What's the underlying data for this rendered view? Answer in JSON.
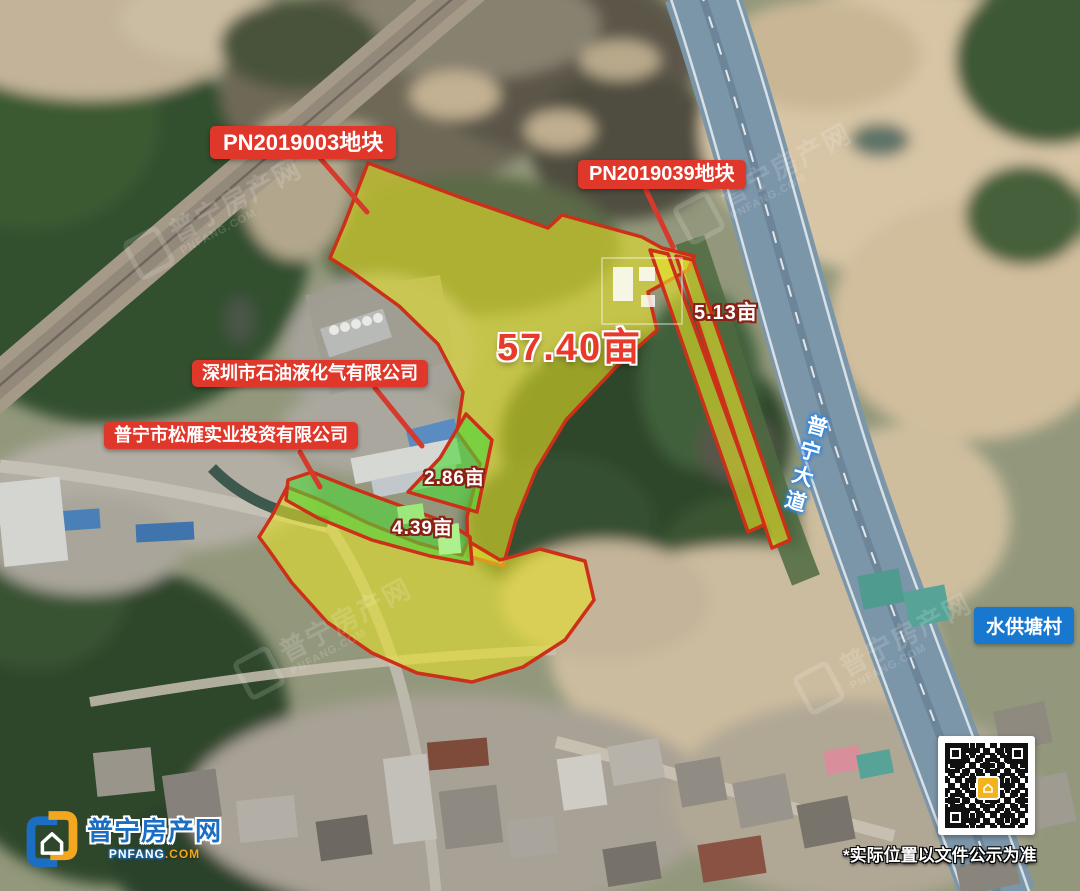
{
  "labels": {
    "parcel1": "PN2019003地块",
    "parcel2": "PN2019039地块",
    "area_main": "57.40亩",
    "area_strip": "5.13亩",
    "area_green_small": "2.86亩",
    "area_green_long": "4.39亩",
    "company1": "深圳市石油液化气有限公司",
    "company2": "普宁市松雁实业投资有限公司",
    "road": "普宁大道",
    "village": "水供塘村",
    "disclaimer": "*实际位置以文件公示为准"
  },
  "branding": {
    "site_name": "普宁房产网",
    "domain_main": "PNFANG",
    "domain_suffix": ".COM",
    "watermark_name": "普宁房产网",
    "watermark_domain": "PNFANG.COM"
  },
  "colors": {
    "label_red": "#e0372b",
    "parcel_yellow": "#e9e426",
    "parcel_green": "#4ed639",
    "parcel_border": "#cc3019",
    "village_blue": "#1877cf",
    "road_blue_gray": "#7c96a9",
    "brand_blue": "#1b6ec2",
    "brand_yellow": "#f2a71e"
  }
}
